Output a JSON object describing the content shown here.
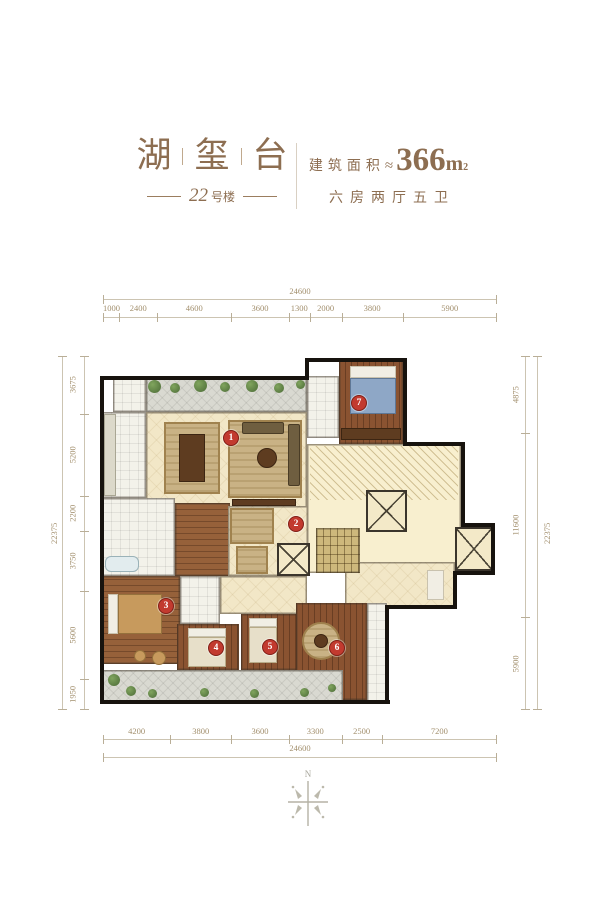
{
  "header": {
    "title_chars": [
      "湖",
      "玺",
      "台"
    ],
    "building_number": "22",
    "building_suffix": "号楼",
    "area_label": "建筑面积",
    "approx_symbol": "≈",
    "area_value": "366",
    "area_unit": "m",
    "area_sup": "2",
    "layout_text": "六房两厅五卫",
    "accent_color": "#8d6e51"
  },
  "floorplan": {
    "marker_color": "#c23a2f",
    "dimensions": {
      "top": {
        "total": "24600",
        "segments": [
          "1000",
          "2400",
          "4600",
          "3600",
          "1300",
          "2000",
          "3800",
          "5900"
        ]
      },
      "bottom": {
        "total": "24600",
        "segments": [
          "4200",
          "3800",
          "3600",
          "3300",
          "2500",
          "7200"
        ]
      },
      "left": {
        "total": "22375",
        "segments": [
          "3675",
          "5200",
          "2200",
          "3750",
          "5600",
          "1950"
        ]
      },
      "right": {
        "total": "22375",
        "segments": [
          "4875",
          "11600",
          "5900"
        ]
      }
    },
    "markers": [
      {
        "num": "1",
        "x": 131,
        "y": 80
      },
      {
        "num": "2",
        "x": 196,
        "y": 166
      },
      {
        "num": "3",
        "x": 66,
        "y": 248
      },
      {
        "num": "4",
        "x": 116,
        "y": 290
      },
      {
        "num": "5",
        "x": 170,
        "y": 289
      },
      {
        "num": "6",
        "x": 237,
        "y": 290
      },
      {
        "num": "7",
        "x": 259,
        "y": 45
      }
    ],
    "rooms": [
      {
        "name": "terrace-top",
        "kind": "terrace",
        "x": 46,
        "y": 20,
        "w": 161,
        "h": 34
      },
      {
        "name": "utility-room",
        "kind": "tile",
        "x": 13,
        "y": 20,
        "w": 33,
        "h": 34
      },
      {
        "name": "living-dining",
        "kind": "cream",
        "x": 46,
        "y": 54,
        "w": 161,
        "h": 96
      },
      {
        "name": "kitchen",
        "kind": "tile",
        "x": 2,
        "y": 54,
        "w": 44,
        "h": 86
      },
      {
        "name": "master-bath",
        "kind": "tile",
        "x": 207,
        "y": 18,
        "w": 32,
        "h": 62
      },
      {
        "name": "bedroom-7",
        "kind": "wood-v",
        "x": 239,
        "y": 2,
        "w": 64,
        "h": 84
      },
      {
        "name": "core-lobby",
        "kind": "core",
        "x": 207,
        "y": 86,
        "w": 154,
        "h": 129
      },
      {
        "name": "core-ext",
        "kind": "core",
        "x": 361,
        "y": 167,
        "w": 32,
        "h": 48
      },
      {
        "name": "core-hatch",
        "kind": "hatch",
        "x": 210,
        "y": 88,
        "w": 148,
        "h": 54
      },
      {
        "name": "stairwell",
        "kind": "stairs",
        "x": 216,
        "y": 170,
        "w": 44,
        "h": 45
      },
      {
        "name": "elevator-1",
        "kind": "elevator",
        "x": 266,
        "y": 132,
        "w": 41,
        "h": 42
      },
      {
        "name": "elevator-2",
        "kind": "elevator",
        "x": 355,
        "y": 169,
        "w": 38,
        "h": 44
      },
      {
        "name": "bathroom-left",
        "kind": "tile",
        "x": 2,
        "y": 140,
        "w": 73,
        "h": 78
      },
      {
        "name": "corridor",
        "kind": "wood-h",
        "x": 75,
        "y": 145,
        "w": 55,
        "h": 73
      },
      {
        "name": "hallway-foyer",
        "kind": "cream",
        "x": 128,
        "y": 148,
        "w": 80,
        "h": 70
      },
      {
        "name": "elevator-3",
        "kind": "elevator",
        "x": 177,
        "y": 185,
        "w": 33,
        "h": 33
      },
      {
        "name": "inner-corridor",
        "kind": "cream",
        "x": 120,
        "y": 218,
        "w": 87,
        "h": 38
      },
      {
        "name": "bathroom-mid",
        "kind": "tile",
        "x": 80,
        "y": 218,
        "w": 40,
        "h": 48
      },
      {
        "name": "bedroom-3",
        "kind": "wood-h",
        "x": 2,
        "y": 218,
        "w": 78,
        "h": 88
      },
      {
        "name": "bedroom-4",
        "kind": "wood-v",
        "x": 77,
        "y": 266,
        "w": 62,
        "h": 46
      },
      {
        "name": "bedroom-5",
        "kind": "wood-v",
        "x": 141,
        "y": 256,
        "w": 57,
        "h": 56
      },
      {
        "name": "entry-hall",
        "kind": "cream",
        "x": 245,
        "y": 204,
        "w": 110,
        "h": 45
      },
      {
        "name": "bedroom-6",
        "kind": "wood-v",
        "x": 196,
        "y": 245,
        "w": 71,
        "h": 97
      },
      {
        "name": "bathroom-6",
        "kind": "tile",
        "x": 267,
        "y": 245,
        "w": 20,
        "h": 99
      },
      {
        "name": "terrace-bottom",
        "kind": "terrace",
        "x": 2,
        "y": 312,
        "w": 241,
        "h": 32
      }
    ],
    "furniture": [
      {
        "name": "dining-rug",
        "kind": "rug",
        "x": 64,
        "y": 64,
        "w": 56,
        "h": 72
      },
      {
        "name": "dining-table",
        "kind": "darkwood",
        "x": 79,
        "y": 76,
        "w": 26,
        "h": 48
      },
      {
        "name": "living-rug",
        "kind": "rug",
        "x": 128,
        "y": 62,
        "w": 74,
        "h": 78
      },
      {
        "name": "sofa-long",
        "kind": "sofa",
        "x": 188,
        "y": 66,
        "w": 12,
        "h": 62
      },
      {
        "name": "sofa-side",
        "kind": "sofa",
        "x": 142,
        "y": 64,
        "w": 42,
        "h": 12
      },
      {
        "name": "coffee-table",
        "kind": "darkwood round",
        "x": 157,
        "y": 90,
        "w": 20,
        "h": 20
      },
      {
        "name": "tv-cabinet",
        "kind": "darkwood",
        "x": 132,
        "y": 141,
        "w": 64,
        "h": 7
      },
      {
        "name": "bed-7-pillows",
        "kind": "pillow",
        "x": 250,
        "y": 8,
        "w": 46,
        "h": 12
      },
      {
        "name": "bed-7",
        "kind": "bed-blue",
        "x": 250,
        "y": 20,
        "w": 46,
        "h": 36
      },
      {
        "name": "wardrobe-7",
        "kind": "darkwood",
        "x": 241,
        "y": 70,
        "w": 60,
        "h": 12
      },
      {
        "name": "kitchen-counter",
        "kind": "counter",
        "x": 4,
        "y": 56,
        "w": 12,
        "h": 82
      },
      {
        "name": "bathtub",
        "kind": "tub",
        "x": 5,
        "y": 198,
        "w": 34,
        "h": 16
      },
      {
        "name": "bed-3-pillows",
        "kind": "pillow",
        "x": 8,
        "y": 236,
        "w": 10,
        "h": 40
      },
      {
        "name": "bed-3",
        "kind": "bed-tan",
        "x": 18,
        "y": 236,
        "w": 44,
        "h": 40
      },
      {
        "name": "pouf-1",
        "kind": "bed-tan round",
        "x": 34,
        "y": 292,
        "w": 12,
        "h": 12
      },
      {
        "name": "pouf-2",
        "kind": "bed-tan round",
        "x": 52,
        "y": 293,
        "w": 14,
        "h": 14
      },
      {
        "name": "bed-4-pillows",
        "kind": "pillow",
        "x": 88,
        "y": 270,
        "w": 38,
        "h": 9
      },
      {
        "name": "bed-4",
        "kind": "bed-cream",
        "x": 88,
        "y": 279,
        "w": 38,
        "h": 30
      },
      {
        "name": "bed-5-pillows",
        "kind": "pillow",
        "x": 149,
        "y": 260,
        "w": 28,
        "h": 9
      },
      {
        "name": "bed-5",
        "kind": "bed-cream",
        "x": 149,
        "y": 269,
        "w": 28,
        "h": 36
      },
      {
        "name": "rug-6",
        "kind": "rug round",
        "x": 202,
        "y": 264,
        "w": 38,
        "h": 38
      },
      {
        "name": "table-6",
        "kind": "darkwood round",
        "x": 214,
        "y": 276,
        "w": 14,
        "h": 14
      },
      {
        "name": "hall-rug",
        "kind": "rug",
        "x": 130,
        "y": 150,
        "w": 44,
        "h": 36
      },
      {
        "name": "runner-rug",
        "kind": "rug",
        "x": 136,
        "y": 188,
        "w": 32,
        "h": 28
      },
      {
        "name": "entry-door",
        "kind": "pillow",
        "x": 327,
        "y": 212,
        "w": 17,
        "h": 30
      },
      {
        "name": "plant",
        "kind": "plant",
        "x": 48,
        "y": 22,
        "w": 13,
        "h": 13
      },
      {
        "name": "plant",
        "kind": "plant",
        "x": 70,
        "y": 25,
        "w": 10,
        "h": 10
      },
      {
        "name": "plant",
        "kind": "plant",
        "x": 94,
        "y": 21,
        "w": 13,
        "h": 13
      },
      {
        "name": "plant",
        "kind": "plant",
        "x": 120,
        "y": 24,
        "w": 10,
        "h": 10
      },
      {
        "name": "plant",
        "kind": "plant",
        "x": 146,
        "y": 22,
        "w": 12,
        "h": 12
      },
      {
        "name": "plant",
        "kind": "plant",
        "x": 174,
        "y": 25,
        "w": 10,
        "h": 10
      },
      {
        "name": "plant",
        "kind": "plant",
        "x": 196,
        "y": 22,
        "w": 9,
        "h": 9
      },
      {
        "name": "plant",
        "kind": "plant",
        "x": 8,
        "y": 316,
        "w": 12,
        "h": 12
      },
      {
        "name": "plant",
        "kind": "plant",
        "x": 26,
        "y": 328,
        "w": 10,
        "h": 10
      },
      {
        "name": "plant",
        "kind": "plant",
        "x": 48,
        "y": 331,
        "w": 9,
        "h": 9
      },
      {
        "name": "plant",
        "kind": "plant",
        "x": 100,
        "y": 330,
        "w": 9,
        "h": 9
      },
      {
        "name": "plant",
        "kind": "plant",
        "x": 150,
        "y": 331,
        "w": 9,
        "h": 9
      },
      {
        "name": "plant",
        "kind": "plant",
        "x": 200,
        "y": 330,
        "w": 9,
        "h": 9
      },
      {
        "name": "plant",
        "kind": "plant",
        "x": 228,
        "y": 326,
        "w": 8,
        "h": 8
      }
    ],
    "walls": [
      {
        "x": 0,
        "y": 18,
        "w": 209,
        "h": 4
      },
      {
        "x": 205,
        "y": 0,
        "w": 102,
        "h": 4
      },
      {
        "x": 303,
        "y": 0,
        "w": 4,
        "h": 88
      },
      {
        "x": 303,
        "y": 84,
        "w": 62,
        "h": 4
      },
      {
        "x": 361,
        "y": 84,
        "w": 4,
        "h": 85
      },
      {
        "x": 361,
        "y": 165,
        "w": 34,
        "h": 4
      },
      {
        "x": 391,
        "y": 165,
        "w": 4,
        "h": 52
      },
      {
        "x": 357,
        "y": 213,
        "w": 38,
        "h": 4
      },
      {
        "x": 353,
        "y": 213,
        "w": 4,
        "h": 38
      },
      {
        "x": 288,
        "y": 247,
        "w": 69,
        "h": 4
      },
      {
        "x": 285,
        "y": 247,
        "w": 4,
        "h": 97
      },
      {
        "x": 0,
        "y": 342,
        "w": 290,
        "h": 4
      },
      {
        "x": 0,
        "y": 18,
        "w": 4,
        "h": 328
      },
      {
        "x": 205,
        "y": 0,
        "w": 4,
        "h": 22
      }
    ]
  },
  "compass": {
    "label": "N"
  }
}
